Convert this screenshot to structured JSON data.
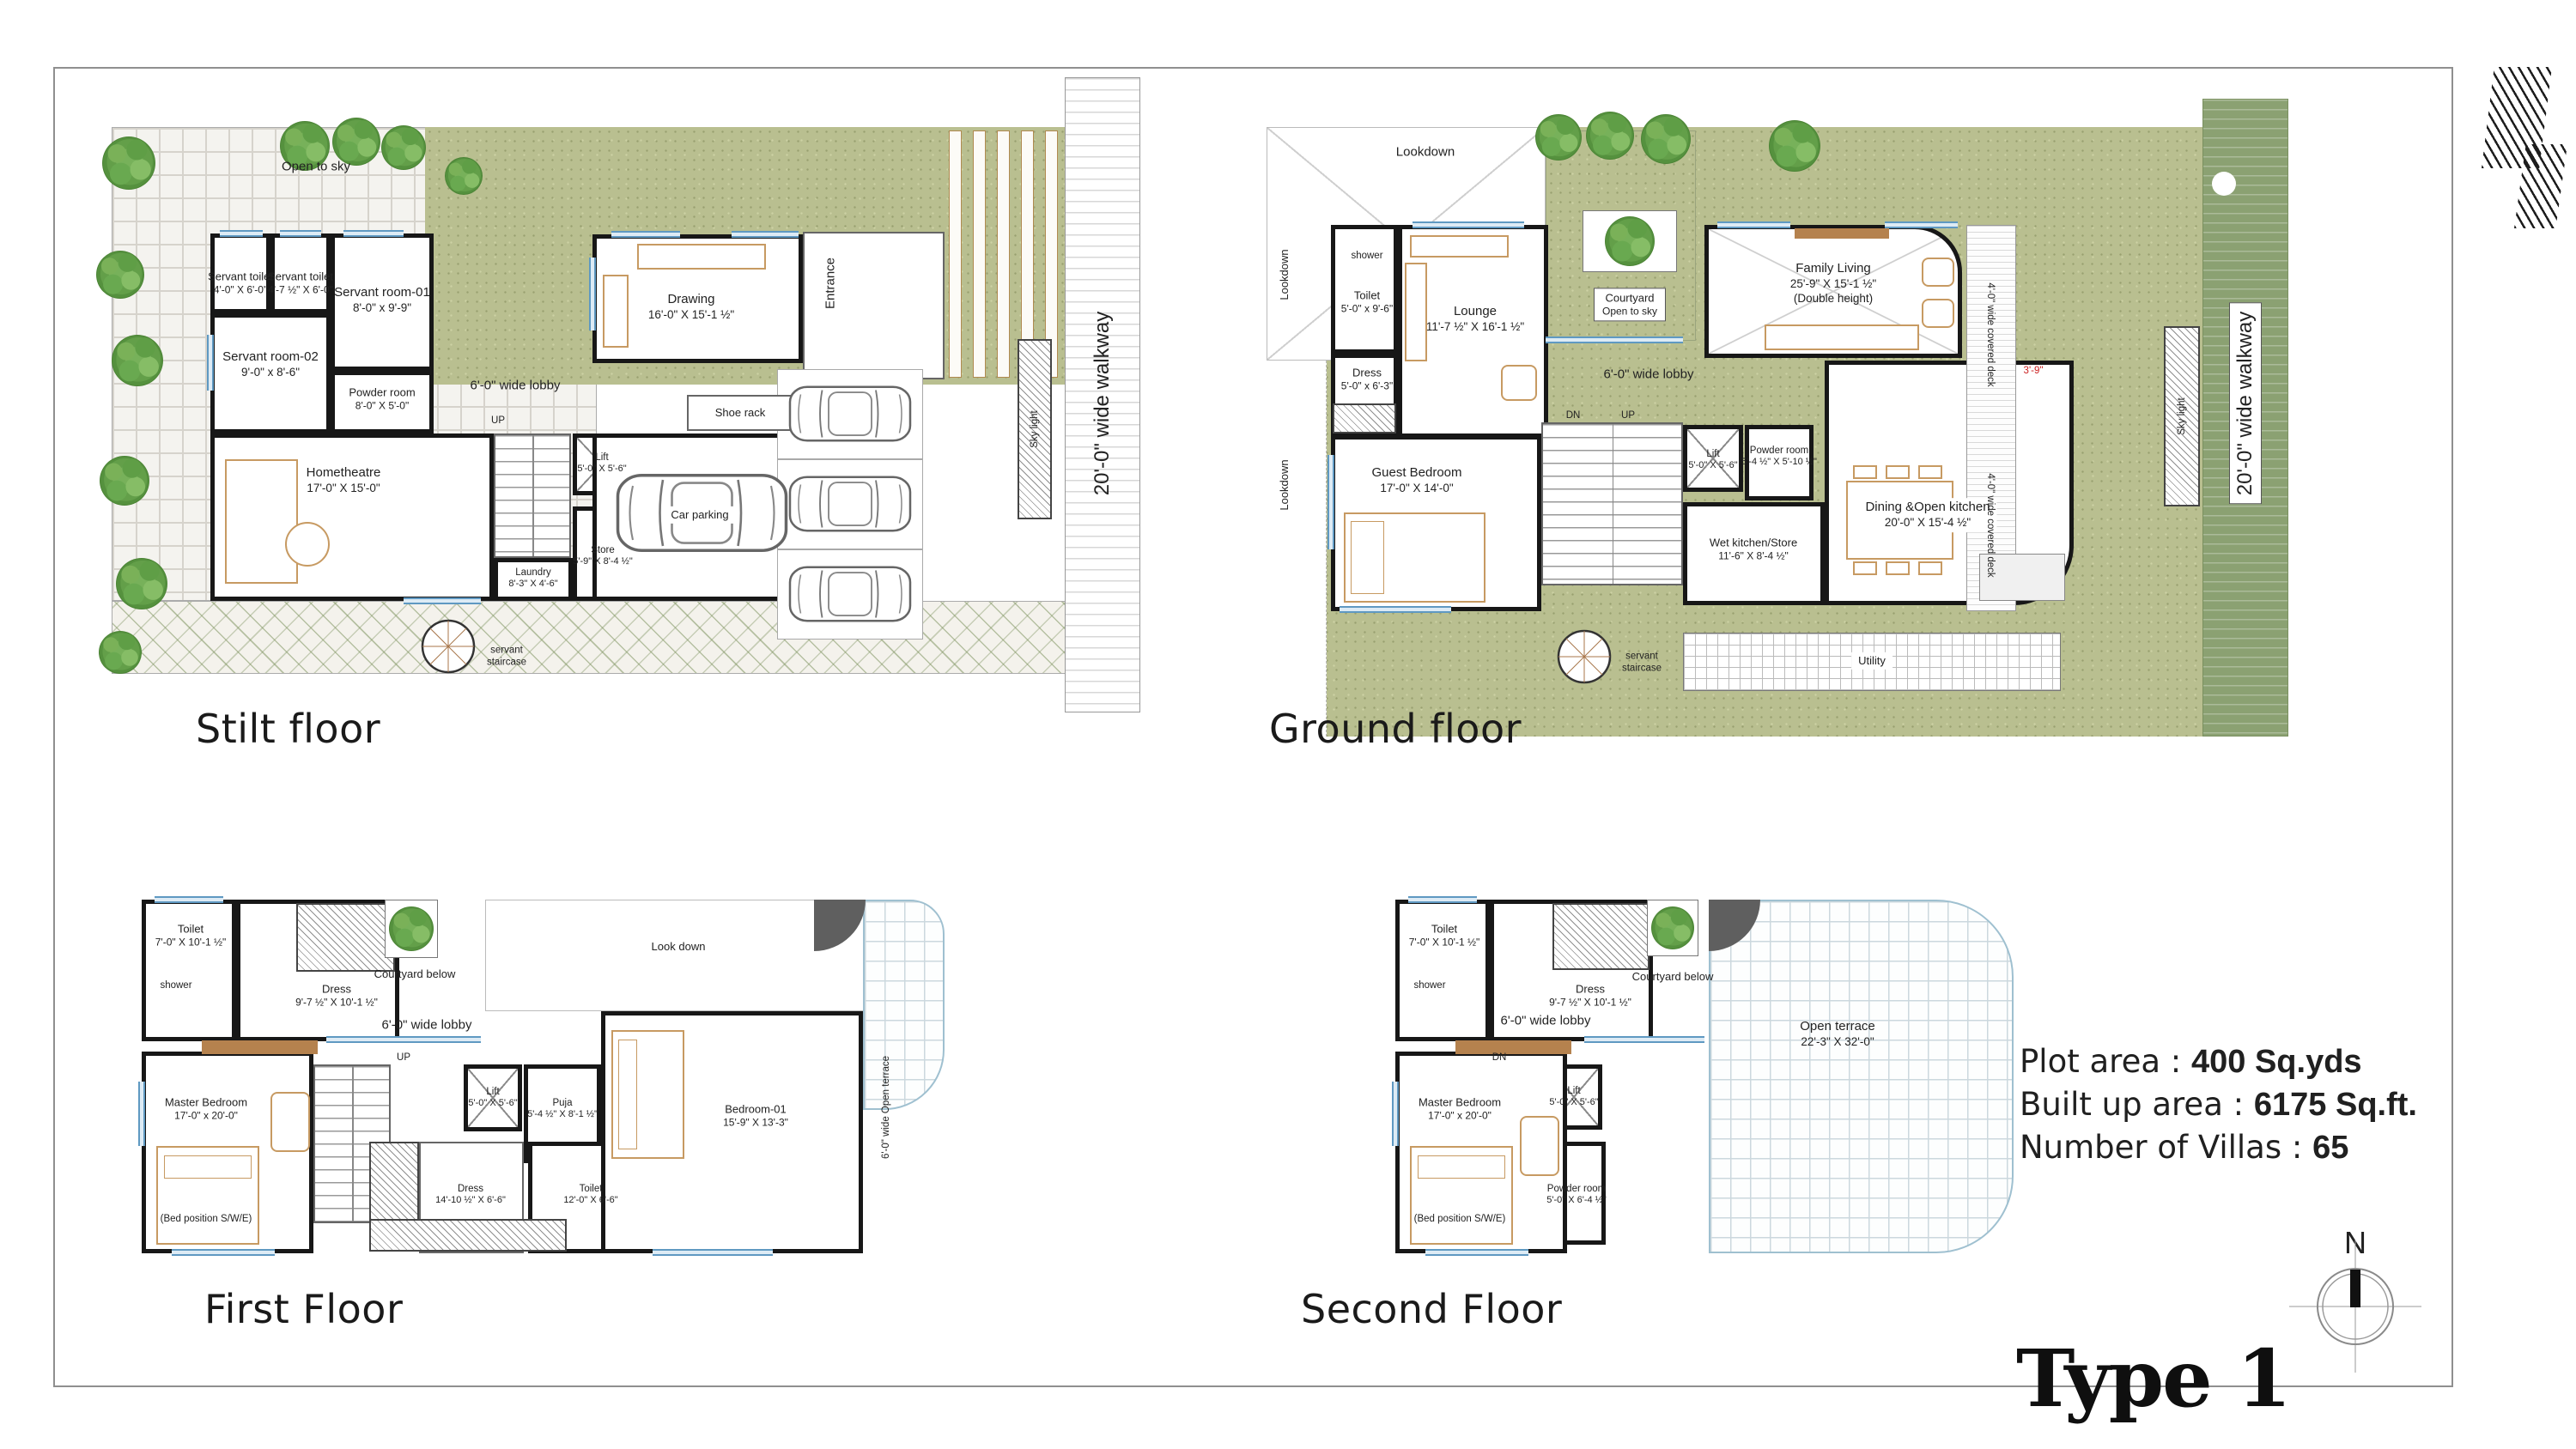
{
  "stilt": {
    "title": "Stilt floor",
    "open_to_sky": "Open to sky",
    "servant_toilet_1": {
      "n": "Servant toilet",
      "d": "4'-0\" X 6'-0\""
    },
    "servant_toilet_2": {
      "n": "Servant toilet",
      "d": "4'-7 ½\" X 6'-0\""
    },
    "servant_room_1": {
      "n": "Servant room-01",
      "d": "8'-0\" x 9'-9\""
    },
    "servant_room_2": {
      "n": "Servant room-02",
      "d": "9'-0\" x 8'-6\""
    },
    "powder_room": {
      "n": "Powder room",
      "d": "8'-0\" X 5'-0\""
    },
    "hometheatre": {
      "n": "Hometheatre",
      "d": "17'-0\" X 15'-0\""
    },
    "drawing": {
      "n": "Drawing",
      "d": "16'-0\" X 15'-1 ½\""
    },
    "lobby": "6'-0\" wide lobby",
    "up": "UP",
    "shoe_rack": "Shoe rack",
    "entrance": "Entrance",
    "lift": {
      "n": "Lift",
      "d": "5'-0\" X 5'-6\""
    },
    "store": {
      "n": "Store",
      "d": "5'-9\" X 8'-4 ½\""
    },
    "laundry": {
      "n": "Laundry",
      "d": "8'-3\" X 4'-6\""
    },
    "car_parking": "Car parking",
    "sky_light": "Sky light",
    "walkway": "20'-0\" wide walkway",
    "servant_staircase": "servant staircase"
  },
  "ground": {
    "title": "Ground floor",
    "lookdown": "Lookdown",
    "shower": "shower",
    "toilet": {
      "n": "Toilet",
      "d": "5'-0\" x 9'-6\""
    },
    "dress": {
      "n": "Dress",
      "d": "5'-0\" x 6'-3\""
    },
    "lounge": {
      "n": "Lounge",
      "d": "11'-7 ½\" X 16'-1 ½\""
    },
    "courtyard": {
      "n": "Courtyard",
      "d": "Open to sky"
    },
    "family_living": {
      "n": "Family Living",
      "d": "25'-9\" X 15'-1 ½\"",
      "e": "(Double height)"
    },
    "lobby": "6'-0\" wide lobby",
    "dn": "DN",
    "up": "UP",
    "guest_bedroom": {
      "n": "Guest Bedroom",
      "d": "17'-0\" X 14'-0\""
    },
    "lift": {
      "n": "Lift",
      "d": "5'-0\" X 5'-6\""
    },
    "powder_room": {
      "n": "Powder room",
      "d": "5'-4 ½\" X 5'-10 ½\""
    },
    "wet_kitchen": {
      "n": "Wet kitchen/Store",
      "d": "11'-6\" X 8'-4 ½\""
    },
    "dining": {
      "n": "Dining &Open kitchen",
      "d": "20'-0\" X 15'-4 ½\""
    },
    "utility": "Utility",
    "servant_staircase": "servant staircase",
    "covered_deck": "4'-0\" wide covered deck",
    "deck_dim": "3'-9\"",
    "sky_light": "Sky light",
    "walkway": "20'-0\" wide walkway"
  },
  "first": {
    "title": "First Floor",
    "shower": "shower",
    "toilet": {
      "n": "Toilet",
      "d": "7'-0\" X 10'-1 ½\""
    },
    "dress": {
      "n": "Dress",
      "d": "9'-7 ½\" X 10'-1 ½\""
    },
    "courtyard_below": "Courtyard below",
    "look_down": "Look down",
    "lobby": "6'-0\" wide lobby",
    "up": "UP",
    "lift": {
      "n": "Lift",
      "d": "5'-0\" X 5'-6\""
    },
    "puja": {
      "n": "Puja",
      "d": "5'-4 ½\" X 8'-1 ½\""
    },
    "master_bedroom": {
      "n": "Master Bedroom",
      "d": "17'-0\" x 20'-0\"",
      "e": "(Bed position S/W/E)"
    },
    "dress2": {
      "n": "Dress",
      "d": "14'-10 ½\" X 6'-6\""
    },
    "toilet2": {
      "n": "Toilet",
      "d": "12'-0\" X 6'-6\""
    },
    "bedroom01": {
      "n": "Bedroom-01",
      "d": "15'-9\" X 13'-3\""
    },
    "open_terrace_side": "6'-0\" wide Open terrace"
  },
  "second": {
    "title": "Second Floor",
    "shower": "shower",
    "toilet": {
      "n": "Toilet",
      "d": "7'-0\" X 10'-1 ½\""
    },
    "dress": {
      "n": "Dress",
      "d": "9'-7 ½\" X 10'-1 ½\""
    },
    "courtyard_below": "Courtyard below",
    "lobby": "6'-0\" wide lobby",
    "dn": "DN",
    "lift": {
      "n": "Lift",
      "d": "5'-0\" X 5'-6\""
    },
    "powder_room": {
      "n": "Powder room",
      "d": "5'-0\" X 6'-4 ½\""
    },
    "master_bedroom": {
      "n": "Master Bedroom",
      "d": "17'-0\" x 20'-0\"",
      "e": "(Bed position S/W/E)"
    },
    "open_terrace": {
      "n": "Open terrace",
      "d": "22'-3\" X 32'-0\""
    }
  },
  "info": {
    "plot_label": "Plot area :",
    "plot_value": "400 Sq.yds",
    "builtup_label": "Built up area :",
    "builtup_value": "6175 Sq.ft.",
    "villas_label": "Number of Villas :",
    "villas_value": "65"
  },
  "footer": {
    "type_label": "Type 1",
    "north_label": "N"
  }
}
